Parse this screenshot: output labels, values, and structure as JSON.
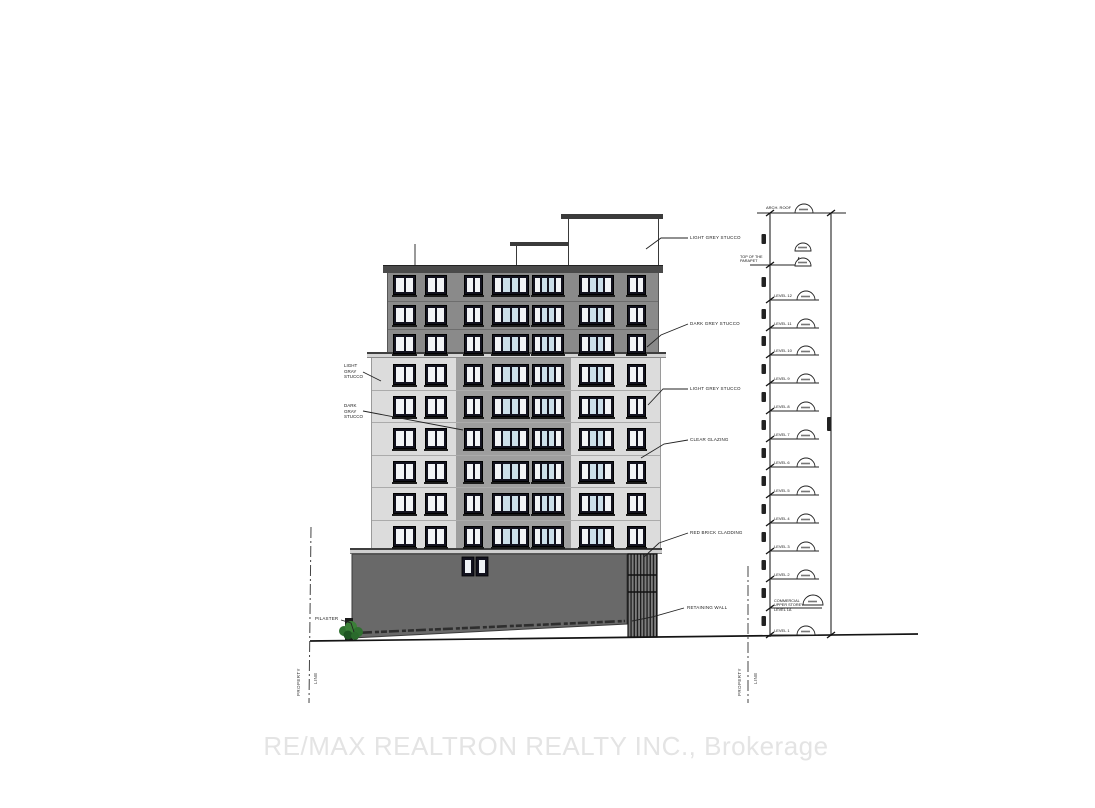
{
  "watermark": "RE/MAX REALTRON REALTY INC., Brokerage",
  "labels": {
    "left": {
      "light_stucco": [
        "LIGHT",
        "GRAY",
        "STUCCO"
      ],
      "dark_stucco": [
        "DARK",
        "GRAY",
        "STUCCO"
      ],
      "pilaster": "PILASTER"
    },
    "right": [
      "LIGHT GREY STUCCO",
      "DARK GREY STUCCO",
      "LIGHT GREY STUCCO",
      "CLEAR GLAZING",
      "RED BRICK CLADDING",
      "RETAINING WALL"
    ],
    "property_line": [
      "PROPERTY",
      "LINE"
    ]
  },
  "elevation_markers": {
    "arch_roof": "ARCH. ROOF",
    "top_of_parapet": [
      "TOP OF THE",
      "PARAPET"
    ],
    "levels": [
      "LEVEL 12",
      "LEVEL 11",
      "LEVEL 10",
      "LEVEL 9",
      "LEVEL 8",
      "LEVEL 7",
      "LEVEL 6",
      "LEVEL 5",
      "LEVEL 4",
      "LEVEL 3",
      "LEVEL 2"
    ],
    "ground_floor": [
      "COMMERCIAL",
      "UPPER STOREY",
      "LEVEL 1A"
    ],
    "level_1": "LEVEL 1"
  },
  "colors": {
    "dark_grey_stucco": "#8a8a8a",
    "light_grey_stucco": "#dcdcdc",
    "mid_grey_bay": "#9e9e9e",
    "retaining_wall": "#696969",
    "window_frame": "#12121e",
    "glazing_blue": "#ccdfe9",
    "planting_green": "#2f7030",
    "watermark_grey": "#e4e4e4"
  }
}
